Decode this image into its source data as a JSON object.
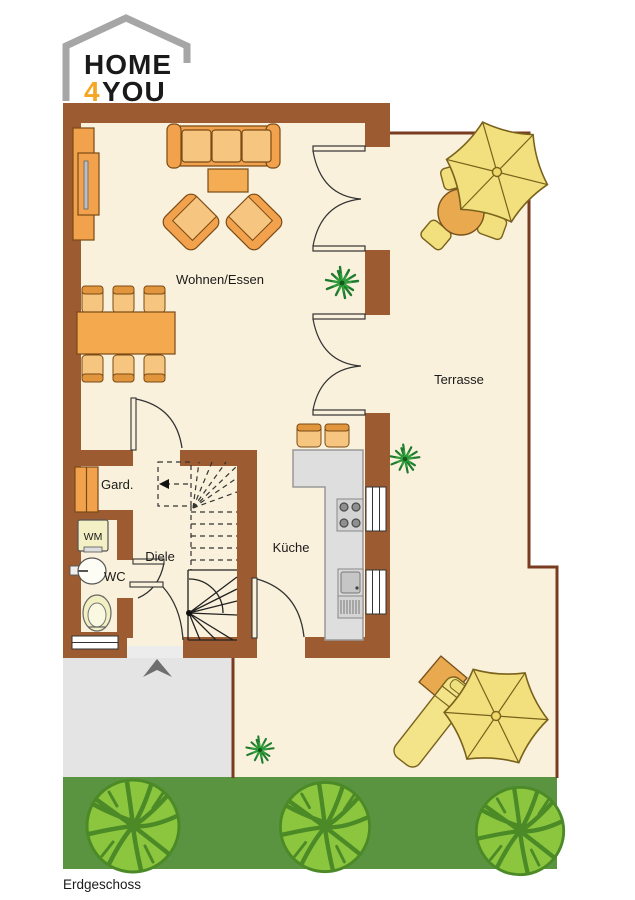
{
  "logo": {
    "word_top": "HOME",
    "accent_char": "4",
    "word_bottom": "YOU"
  },
  "labels": {
    "living": "Wohnen/Essen",
    "terrace": "Terrasse",
    "kitchen": "Küche",
    "hall": "Diele",
    "wc": "WC",
    "wardrobe": "Gard.",
    "washing_machine": "WM",
    "floor": "Erdgeschoss"
  },
  "colors": {
    "wall_brown": "#9C5B30",
    "outline_brown": "#7A3C20",
    "floor_cream": "#F9F1DB",
    "furniture_orange": "#F2A24C",
    "furniture_light_orange": "#F6C57F",
    "chair_band_orange": "#E1953C",
    "parasol_yellow": "#F2DF7D",
    "lounger_yellow": "#F3E389",
    "round_table_orange": "#E9A94E",
    "counter_gray": "#DEDEDE",
    "paving_gray": "#E4E4E4",
    "grass_green": "#5A9440",
    "bush_green": "#8CC63F",
    "bush_vein_green": "#4C8A28",
    "plant_green": "#1E7A2C",
    "logo_accent": "#F5A623",
    "logo_house_gray": "#A6A6A6"
  }
}
